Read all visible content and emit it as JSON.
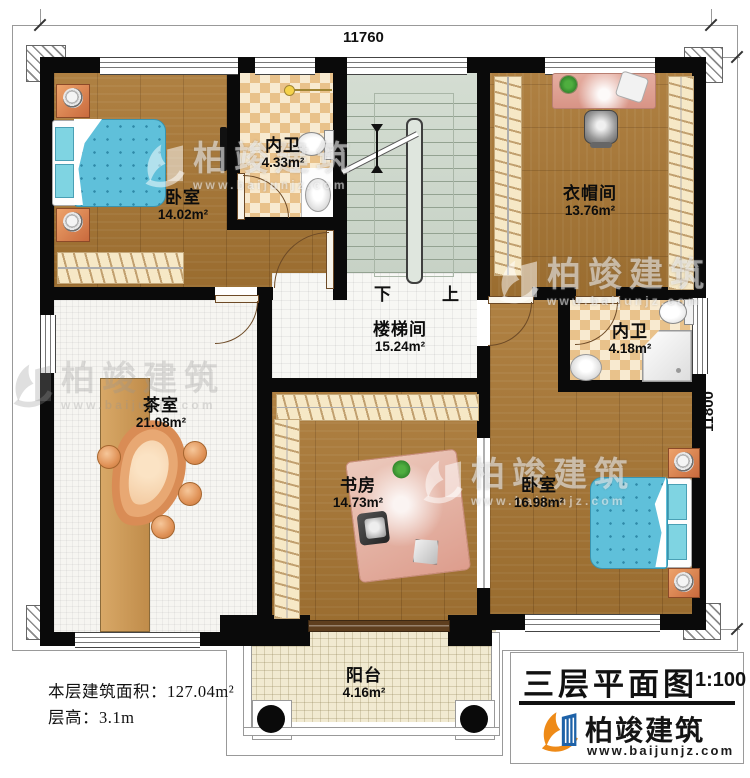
{
  "dimensions": {
    "top": "11760",
    "right": "11800"
  },
  "rooms": [
    {
      "name": "卧室",
      "area": "14.02m²"
    },
    {
      "name": "内卫",
      "area": "4.33m²"
    },
    {
      "name": "衣帽间",
      "area": "13.76m²"
    },
    {
      "name": "内卫",
      "area": "4.18m²"
    },
    {
      "name": "楼梯间",
      "area": "15.24m²"
    },
    {
      "name": "茶室",
      "area": "21.08m²"
    },
    {
      "name": "书房",
      "area": "14.73m²"
    },
    {
      "name": "卧室",
      "area": "16.98m²"
    },
    {
      "name": "阳台",
      "area": "4.16m²"
    }
  ],
  "stairs": {
    "down": "下",
    "up": "上"
  },
  "info": {
    "area_label": "本层建筑面积：",
    "area_value": "127.04m²",
    "height_label": "层高：",
    "height_value": "3.1m"
  },
  "title": {
    "text": "三层平面图",
    "scale": "1:100"
  },
  "brand": {
    "name": "柏竣建筑",
    "url": "www.baijunjz.com"
  },
  "watermark": {
    "name": "柏竣建筑",
    "url": "www.baijunjz.com"
  },
  "colors": {
    "wall": "#0a0a0a",
    "wood_floor": "#a97734",
    "checker_tile": "#e9c28b",
    "stair_floor": "#cdd7cb",
    "brand_blue": "#1e62a8",
    "brand_orange": "#ee8a17"
  }
}
